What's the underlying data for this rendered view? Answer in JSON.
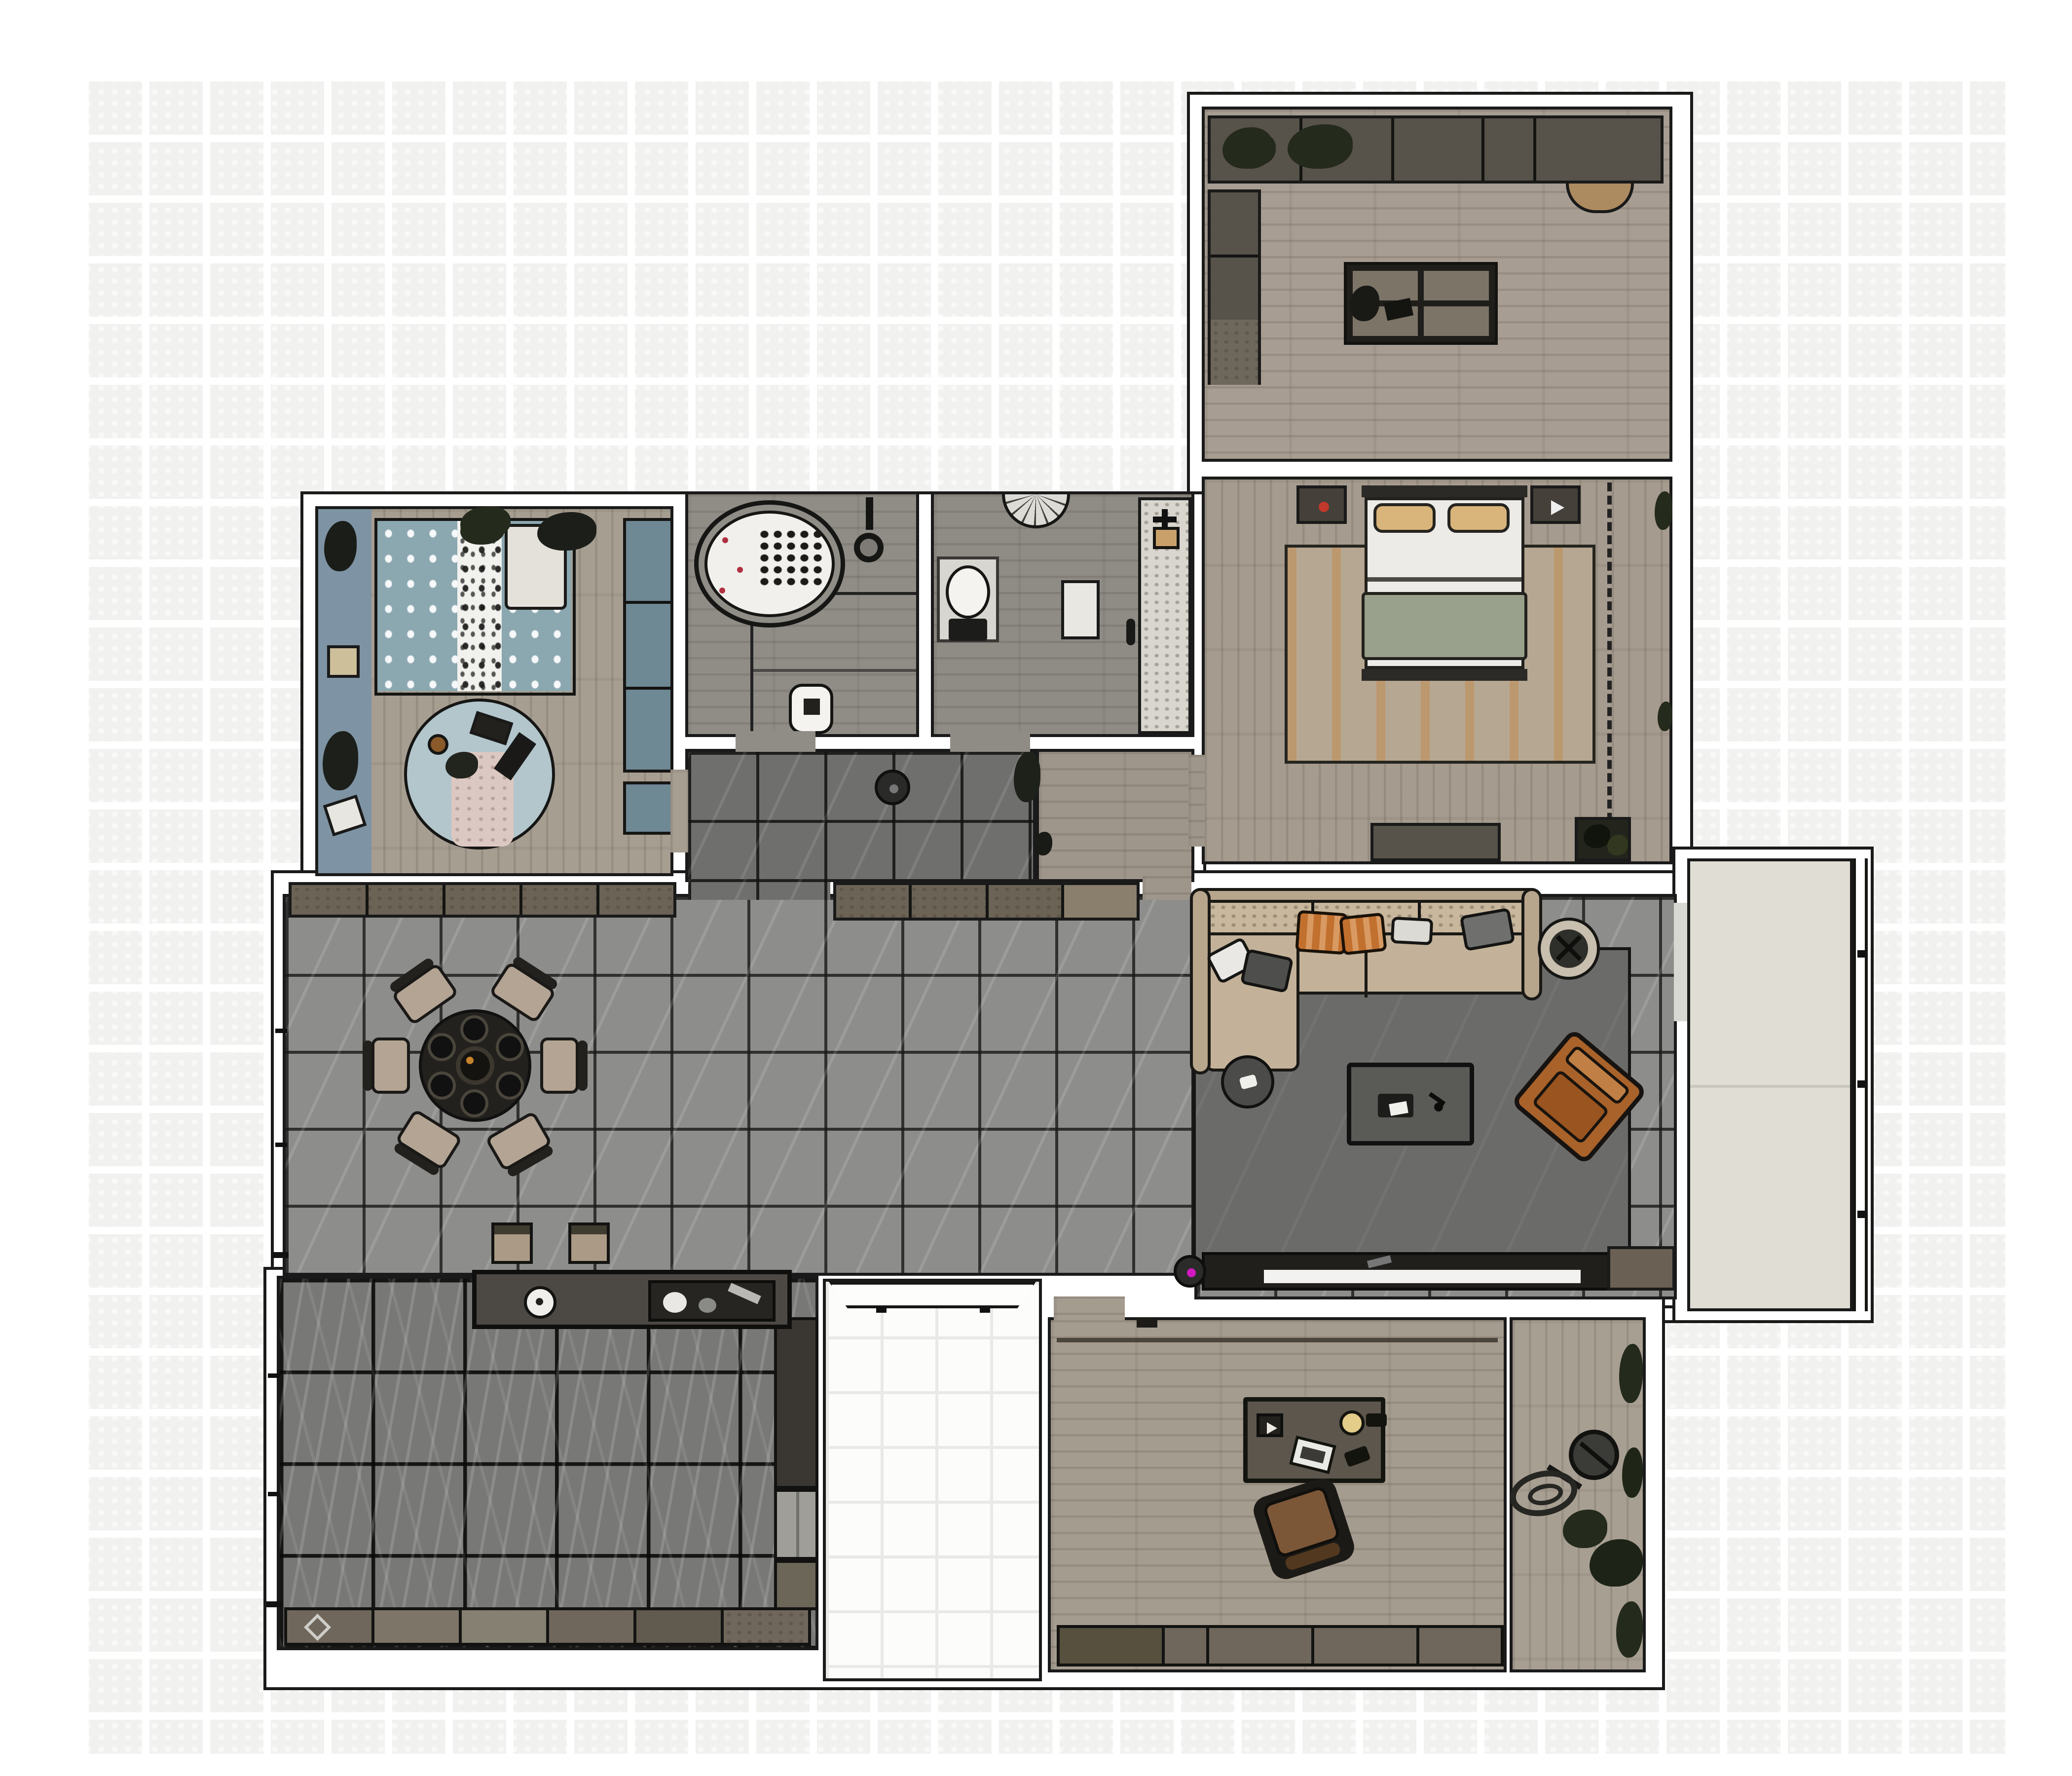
{
  "document": {
    "kind": "interior floor plan rendering, top-down view",
    "visible_text": [],
    "background": "white canvas with faint light-gray mosaic tile grid"
  },
  "colors": {
    "wallLine": "#1a1a1a",
    "wallFill": "#ffffff",
    "hallTile": "#8d8d8b",
    "corridorTile": "#6f6f6d",
    "kitchenFloor": "#787876",
    "porchFloor": "#fcfcfb",
    "studyFloor": "#a79d92",
    "bedroomFloor": "#a59b8e",
    "kidsFloor": "#a79e92",
    "bathFloor": "#908d87",
    "wcFloor": "#8f8b85",
    "officeFloor": "#a59c90",
    "terraceFloor": "#a89f93",
    "balconyFloor": "#e0ded4",
    "rugLiving": "#6b6b69",
    "counterDark": "#57524a",
    "cabinetBrown": "#6b6356",
    "islandDark": "#4c4844",
    "sofaBody": "#c3b299",
    "sofaBack": "#b7a68c",
    "pillowOrange": "#c2702e",
    "pillowOrangeLight": "#d89a62",
    "pillowGray": "#4e4e4c",
    "armchair": "#a8622a",
    "armchairLight": "#c07f45",
    "coffeeTable": "#5a5a57",
    "sideTable": "#4b4b49",
    "plantRing": "#c9bfae",
    "foliage": "#242a1c",
    "chair": "#b3a493",
    "tableDark": "#23211d",
    "bedSheet": "#ecebe7",
    "bedBlanket": "#99a08b",
    "pillowTan": "#d9b57c",
    "bedFrame": "#2b2a26",
    "rugBedroomBase": "#b6a792",
    "rugBedroomAccent": "#c8823c",
    "dresser": "#57524a",
    "kidsTeal": "#8ba7b0",
    "kidsTealDark": "#6e8894",
    "kidsPanel": "#7e94a4",
    "kidsRug": "#b2c6cc",
    "kidsPink": "#dcc8c2",
    "tubWhite": "#f1f0ec",
    "vanitySpeckle": "#d9d6cf",
    "applianceWhite": "#f4f3f0",
    "fridge": "#a09e99",
    "cabinetOffice": "#6f675c",
    "desk": "#5c564c",
    "deskChair": "#7b5637",
    "lampYellow": "#e3cd88",
    "tvStrip": "#f2f2f0",
    "consoleDark": "#211f1c",
    "vacuumMagenta": "#d019c0",
    "alarmRed": "#c0392b",
    "matLight": "#d8d6d0"
  },
  "rooms": [
    {
      "id": "study",
      "name": "study / multipurpose room",
      "furniture": [
        "wall-counter-with-plants",
        "side-cabinet-column",
        "four-panel-island-table",
        "desk-chair",
        "counter-stool"
      ]
    },
    {
      "id": "master-bedroom",
      "name": "master bedroom",
      "furniture": [
        "double-bed",
        "nightstand-left",
        "nightstand-right",
        "area-rug-rust",
        "dresser",
        "planter",
        "wardrobe-dashed-zone"
      ]
    },
    {
      "id": "kids-bedroom",
      "name": "kids bedroom",
      "furniture": [
        "single-bed-teal",
        "wall-desk-panel",
        "closet-column",
        "round-play-rug",
        "toys"
      ]
    },
    {
      "id": "bathroom",
      "name": "bathroom",
      "furniture": [
        "oval-bathtub",
        "shower-head",
        "washing-machine"
      ]
    },
    {
      "id": "wc",
      "name": "toilet room",
      "furniture": [
        "wall-hung-toilet",
        "corner-basin",
        "vanity-counter",
        "floor-mat"
      ]
    },
    {
      "id": "corridor",
      "name": "corridor",
      "furniture": [
        "robot-vacuum",
        "plant"
      ]
    },
    {
      "id": "dining-hall",
      "name": "dining / hall",
      "furniture": [
        "round-dining-table",
        "dining-chairs-x6",
        "sideboard-left",
        "sideboard-right",
        "bar-stools-x2"
      ]
    },
    {
      "id": "living-room",
      "name": "living room",
      "furniture": [
        "sectional-sofa",
        "chaise",
        "throw-pillows",
        "side-table",
        "coffee-table",
        "leather-armchair",
        "potted-tree",
        "tv-console",
        "robot-vacuum",
        "large-rug"
      ]
    },
    {
      "id": "kitchen",
      "name": "kitchen",
      "furniture": [
        "island-with-sink-and-cooktop",
        "base-cabinet-row",
        "tall-cabinets-fridge"
      ]
    },
    {
      "id": "entry-porch",
      "name": "entry porch",
      "furniture": [
        "entrance-door"
      ]
    },
    {
      "id": "office",
      "name": "office / den",
      "furniture": [
        "desk-with-lamp-laptop",
        "office-chair",
        "cabinet-row"
      ]
    },
    {
      "id": "terrace",
      "name": "utility terrace",
      "furniture": [
        "standing-fan",
        "coiled-hose",
        "plants"
      ]
    },
    {
      "id": "balcony",
      "name": "balcony",
      "furniture": [
        "railing"
      ]
    }
  ]
}
